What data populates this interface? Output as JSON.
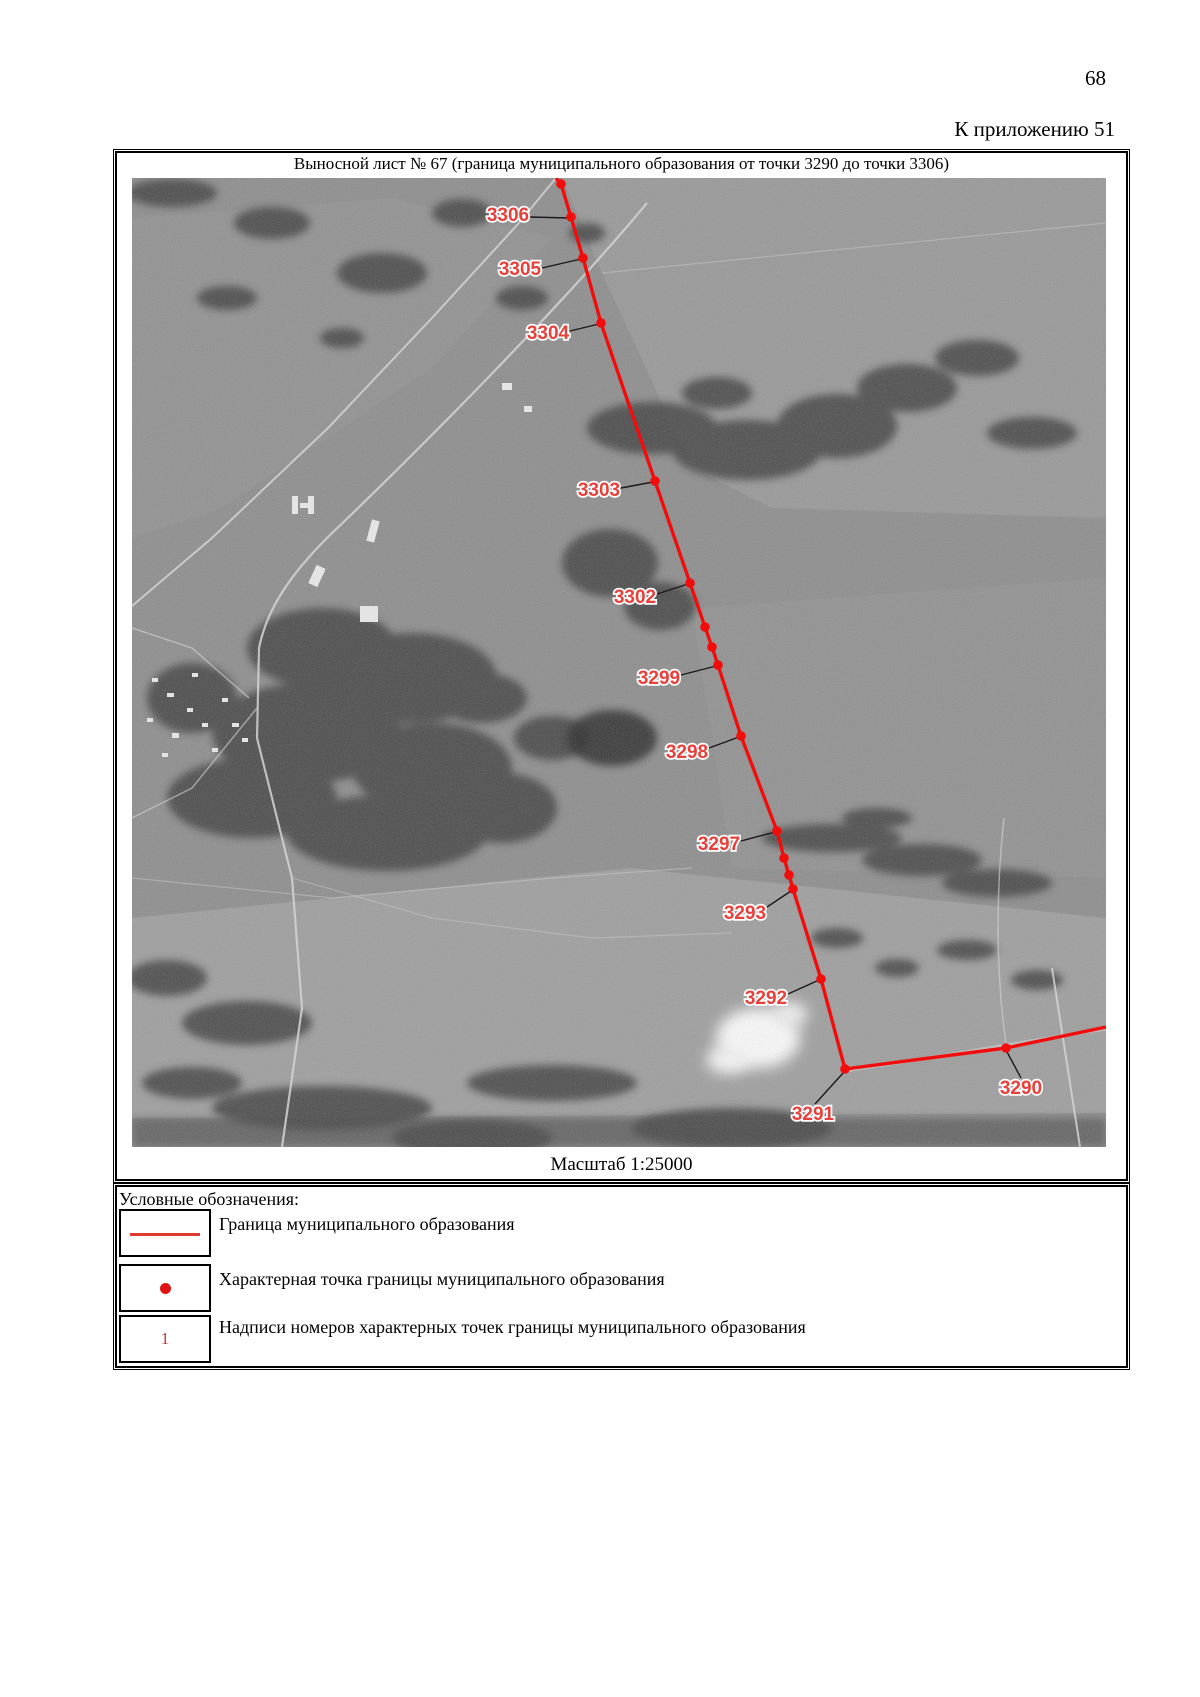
{
  "page": {
    "number": "68",
    "appendix_note": "К приложению 51"
  },
  "map_sheet": {
    "title": "Выносной лист № 67 (граница муниципального образования от точки 3290 до точки 3306)",
    "scale_label": "Масштаб 1:25000",
    "point_ids": [
      "3306",
      "3305",
      "3304",
      "3303",
      "3302",
      "3299",
      "3298",
      "3297",
      "3293",
      "3292",
      "3291",
      "3290"
    ],
    "colors": {
      "boundary_line": "#f20d0d",
      "point_dot": "#f20d0d",
      "label_fill": "#e8403a",
      "label_halo": "#ffffff",
      "leader_line": "#1a1a1a"
    },
    "boundary": {
      "vertices": [
        [
          424,
          0
        ],
        [
          429,
          6
        ],
        [
          439,
          39
        ],
        [
          451,
          80
        ],
        [
          469,
          145
        ],
        [
          523,
          303
        ],
        [
          558,
          405
        ],
        [
          573,
          449
        ],
        [
          580,
          469
        ],
        [
          586,
          487
        ],
        [
          609,
          558
        ],
        [
          645,
          653
        ],
        [
          652,
          680
        ],
        [
          657,
          697
        ],
        [
          661,
          711
        ],
        [
          689,
          801
        ],
        [
          713,
          891
        ],
        [
          874,
          870
        ],
        [
          974,
          849
        ]
      ],
      "dots": [
        [
          429,
          6
        ],
        [
          439,
          39
        ],
        [
          451,
          80
        ],
        [
          469,
          145
        ],
        [
          523,
          303
        ],
        [
          558,
          405
        ],
        [
          573,
          449
        ],
        [
          580,
          469
        ],
        [
          586,
          487
        ],
        [
          609,
          558
        ],
        [
          645,
          653
        ],
        [
          652,
          680
        ],
        [
          657,
          697
        ],
        [
          661,
          711
        ],
        [
          689,
          801
        ],
        [
          713,
          891
        ],
        [
          874,
          870
        ]
      ],
      "labels": [
        {
          "text": "3306",
          "x": 376,
          "y": 38,
          "leader": [
            [
              398,
              39
            ],
            [
              437,
              40
            ]
          ]
        },
        {
          "text": "3305",
          "x": 388,
          "y": 92,
          "leader": [
            [
              410,
              90
            ],
            [
              449,
              81
            ]
          ]
        },
        {
          "text": "3304",
          "x": 416,
          "y": 156,
          "leader": [
            [
              438,
              153
            ],
            [
              467,
              146
            ]
          ]
        },
        {
          "text": "3303",
          "x": 467,
          "y": 313,
          "leader": [
            [
              489,
              310
            ],
            [
              521,
              304
            ]
          ]
        },
        {
          "text": "3302",
          "x": 503,
          "y": 420,
          "leader": [
            [
              525,
              416
            ],
            [
              556,
              406
            ]
          ]
        },
        {
          "text": "3299",
          "x": 527,
          "y": 501,
          "leader": [
            [
              549,
              497
            ],
            [
              584,
              488
            ]
          ]
        },
        {
          "text": "3298",
          "x": 555,
          "y": 575,
          "leader": [
            [
              577,
              570
            ],
            [
              607,
              559
            ]
          ]
        },
        {
          "text": "3297",
          "x": 587,
          "y": 667,
          "leader": [
            [
              609,
              663
            ],
            [
              643,
              654
            ]
          ]
        },
        {
          "text": "3293",
          "x": 613,
          "y": 736,
          "leader": [
            [
              635,
              729
            ],
            [
              659,
              713
            ]
          ]
        },
        {
          "text": "3292",
          "x": 634,
          "y": 821,
          "leader": [
            [
              656,
              816
            ],
            [
              687,
              802
            ]
          ]
        },
        {
          "text": "3291",
          "x": 681,
          "y": 937,
          "leader": [
            [
              683,
              926
            ],
            [
              712,
              894
            ]
          ]
        },
        {
          "text": "3290",
          "x": 889,
          "y": 911,
          "leader": [
            [
              889,
              900
            ],
            [
              874,
              872
            ]
          ]
        }
      ]
    }
  },
  "legend": {
    "header": "Условные обозначения:",
    "items": [
      {
        "symbol": "line",
        "label": "Граница муниципального образования"
      },
      {
        "symbol": "dot",
        "label": "Характерная точка границы муниципального образования"
      },
      {
        "symbol": "number",
        "symbol_text": "1",
        "label": "Надписи номеров характерных точек границы муниципального образования"
      }
    ]
  }
}
